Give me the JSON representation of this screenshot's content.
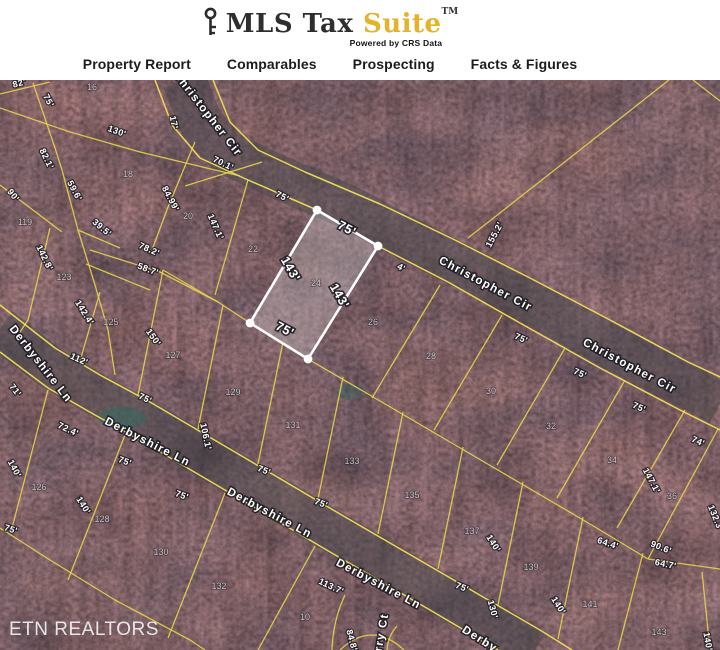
{
  "header": {
    "brand": {
      "name": "MLS Tax",
      "suite": "Suite",
      "trademark": "TM",
      "tagline": "Powered by CRS Data",
      "suite_color": "#e4b32a",
      "key_icon": "key-icon"
    },
    "nav": [
      {
        "label": "Property Report"
      },
      {
        "label": "Comparables"
      },
      {
        "label": "Prospecting"
      },
      {
        "label": "Facts & Figures"
      }
    ]
  },
  "map": {
    "watermark": "ETN REALTORS",
    "colors": {
      "parcel_line_yellow": "#e7d44b",
      "highlight_white": "#ffffff",
      "forest_base": "#382c34"
    },
    "highlighted_parcel": {
      "lot_number": "24",
      "street": "Christopher Cir",
      "frontage": "75'",
      "depth": "143'",
      "labels": [
        {
          "t": "75'",
          "x": 345,
          "y": 152,
          "r": 28
        },
        {
          "t": "143'",
          "x": 287,
          "y": 191,
          "r": 60
        },
        {
          "t": "143'",
          "x": 336,
          "y": 218,
          "r": 60
        },
        {
          "t": "75'",
          "x": 283,
          "y": 253,
          "r": 28
        }
      ]
    },
    "street_labels": [
      {
        "t": "Christopher Cir",
        "x": 205,
        "y": 36,
        "r": 52
      },
      {
        "t": "Christopher Cir",
        "x": 484,
        "y": 207,
        "r": 28
      },
      {
        "t": "Christopher Cir",
        "x": 628,
        "y": 289,
        "r": 28
      },
      {
        "t": "Derbyshire Ln",
        "x": 38,
        "y": 286,
        "r": 52
      },
      {
        "t": "Derbyshire Ln",
        "x": 146,
        "y": 365,
        "r": 27
      },
      {
        "t": "Derbyshire Ln",
        "x": 268,
        "y": 436,
        "r": 28
      },
      {
        "t": "Derbyshire Ln",
        "x": 377,
        "y": 507,
        "r": 28
      },
      {
        "t": "Derby",
        "x": 478,
        "y": 562,
        "r": 32
      },
      {
        "t": "rry Ct",
        "x": 385,
        "y": 553,
        "r": -80
      }
    ],
    "lot_numbers": [
      {
        "t": "16",
        "x": 92,
        "y": 10
      },
      {
        "t": "18",
        "x": 128,
        "y": 97
      },
      {
        "t": "20",
        "x": 188,
        "y": 139
      },
      {
        "t": "22",
        "x": 253,
        "y": 172
      },
      {
        "t": "24",
        "x": 316,
        "y": 206
      },
      {
        "t": "26",
        "x": 373,
        "y": 245
      },
      {
        "t": "28",
        "x": 431,
        "y": 279
      },
      {
        "t": "30",
        "x": 491,
        "y": 314
      },
      {
        "t": "32",
        "x": 551,
        "y": 349
      },
      {
        "t": "34",
        "x": 612,
        "y": 383
      },
      {
        "t": "36",
        "x": 672,
        "y": 419
      },
      {
        "t": "119",
        "x": 25,
        "y": 145
      },
      {
        "t": "123",
        "x": 64,
        "y": 200
      },
      {
        "t": "125",
        "x": 111,
        "y": 245
      },
      {
        "t": "127",
        "x": 173,
        "y": 278
      },
      {
        "t": "129",
        "x": 233,
        "y": 315
      },
      {
        "t": "131",
        "x": 293,
        "y": 348
      },
      {
        "t": "133",
        "x": 352,
        "y": 384
      },
      {
        "t": "135",
        "x": 412,
        "y": 418
      },
      {
        "t": "137",
        "x": 472,
        "y": 454
      },
      {
        "t": "139",
        "x": 531,
        "y": 490
      },
      {
        "t": "141",
        "x": 590,
        "y": 527
      },
      {
        "t": "143",
        "x": 659,
        "y": 555
      },
      {
        "t": "126",
        "x": 39,
        "y": 410
      },
      {
        "t": "128",
        "x": 102,
        "y": 442
      },
      {
        "t": "130",
        "x": 161,
        "y": 475
      },
      {
        "t": "132",
        "x": 219,
        "y": 509
      },
      {
        "t": "10",
        "x": 305,
        "y": 540
      }
    ],
    "dimension_labels": [
      {
        "t": "82'",
        "x": 20,
        "y": 6,
        "r": -15
      },
      {
        "t": "75'",
        "x": 46,
        "y": 22,
        "r": 62
      },
      {
        "t": "130'",
        "x": 116,
        "y": 54,
        "r": 20
      },
      {
        "t": "17'",
        "x": 171,
        "y": 43,
        "r": 78
      },
      {
        "t": "82.1'",
        "x": 44,
        "y": 80,
        "r": 64
      },
      {
        "t": "90'",
        "x": 11,
        "y": 117,
        "r": 52
      },
      {
        "t": "59.6'",
        "x": 72,
        "y": 112,
        "r": 62
      },
      {
        "t": "39.5'",
        "x": 100,
        "y": 150,
        "r": 40
      },
      {
        "t": "70.1'",
        "x": 222,
        "y": 86,
        "r": 26
      },
      {
        "t": "84.99'",
        "x": 168,
        "y": 120,
        "r": 62
      },
      {
        "t": "147.1'",
        "x": 213,
        "y": 148,
        "r": 66
      },
      {
        "t": "78.2'",
        "x": 148,
        "y": 172,
        "r": 24
      },
      {
        "t": "58.7'",
        "x": 147,
        "y": 192,
        "r": 20
      },
      {
        "t": "142.8'",
        "x": 42,
        "y": 179,
        "r": 64
      },
      {
        "t": "155.2'",
        "x": 497,
        "y": 156,
        "r": -62
      },
      {
        "t": "142.4'",
        "x": 82,
        "y": 234,
        "r": 58
      },
      {
        "t": "150'",
        "x": 151,
        "y": 259,
        "r": 55
      },
      {
        "t": "112'",
        "x": 78,
        "y": 282,
        "r": 24
      },
      {
        "t": "71'",
        "x": 13,
        "y": 312,
        "r": 52
      },
      {
        "t": "72.4'",
        "x": 67,
        "y": 352,
        "r": 25
      },
      {
        "t": "75'",
        "x": 144,
        "y": 321,
        "r": 25
      },
      {
        "t": "106.1'",
        "x": 203,
        "y": 357,
        "r": 78
      },
      {
        "t": "140'",
        "x": 12,
        "y": 390,
        "r": 62
      },
      {
        "t": "75'",
        "x": 124,
        "y": 384,
        "r": 20
      },
      {
        "t": "140'",
        "x": 81,
        "y": 427,
        "r": 58
      },
      {
        "t": "75'",
        "x": 10,
        "y": 452,
        "r": 18
      },
      {
        "t": "75'",
        "x": 181,
        "y": 418,
        "r": 20
      },
      {
        "t": "75'",
        "x": 281,
        "y": 119,
        "r": 27
      },
      {
        "t": "4'",
        "x": 400,
        "y": 190,
        "r": 27
      },
      {
        "t": "75'",
        "x": 263,
        "y": 393,
        "r": 22
      },
      {
        "t": "75'",
        "x": 320,
        "y": 426,
        "r": 22
      },
      {
        "t": "75'",
        "x": 461,
        "y": 510,
        "r": 22
      },
      {
        "t": "113.7'",
        "x": 330,
        "y": 509,
        "r": 25
      },
      {
        "t": "84.8'",
        "x": 349,
        "y": 561,
        "r": 75
      },
      {
        "t": "130'",
        "x": 490,
        "y": 530,
        "r": 75
      },
      {
        "t": "75'",
        "x": 520,
        "y": 261,
        "r": 24
      },
      {
        "t": "75'",
        "x": 579,
        "y": 296,
        "r": 24
      },
      {
        "t": "75'",
        "x": 638,
        "y": 330,
        "r": 24
      },
      {
        "t": "74'",
        "x": 697,
        "y": 364,
        "r": 24
      },
      {
        "t": "147.1'",
        "x": 649,
        "y": 402,
        "r": 62
      },
      {
        "t": "132.3'",
        "x": 713,
        "y": 439,
        "r": 68
      },
      {
        "t": "140'",
        "x": 491,
        "y": 465,
        "r": 58
      },
      {
        "t": "64.4'",
        "x": 607,
        "y": 466,
        "r": 18
      },
      {
        "t": "90.6'",
        "x": 660,
        "y": 470,
        "r": 22
      },
      {
        "t": "64.7'",
        "x": 665,
        "y": 487,
        "r": 12
      },
      {
        "t": "140'",
        "x": 556,
        "y": 527,
        "r": 58
      },
      {
        "t": "140'",
        "x": 705,
        "y": 562,
        "r": 80
      }
    ]
  }
}
